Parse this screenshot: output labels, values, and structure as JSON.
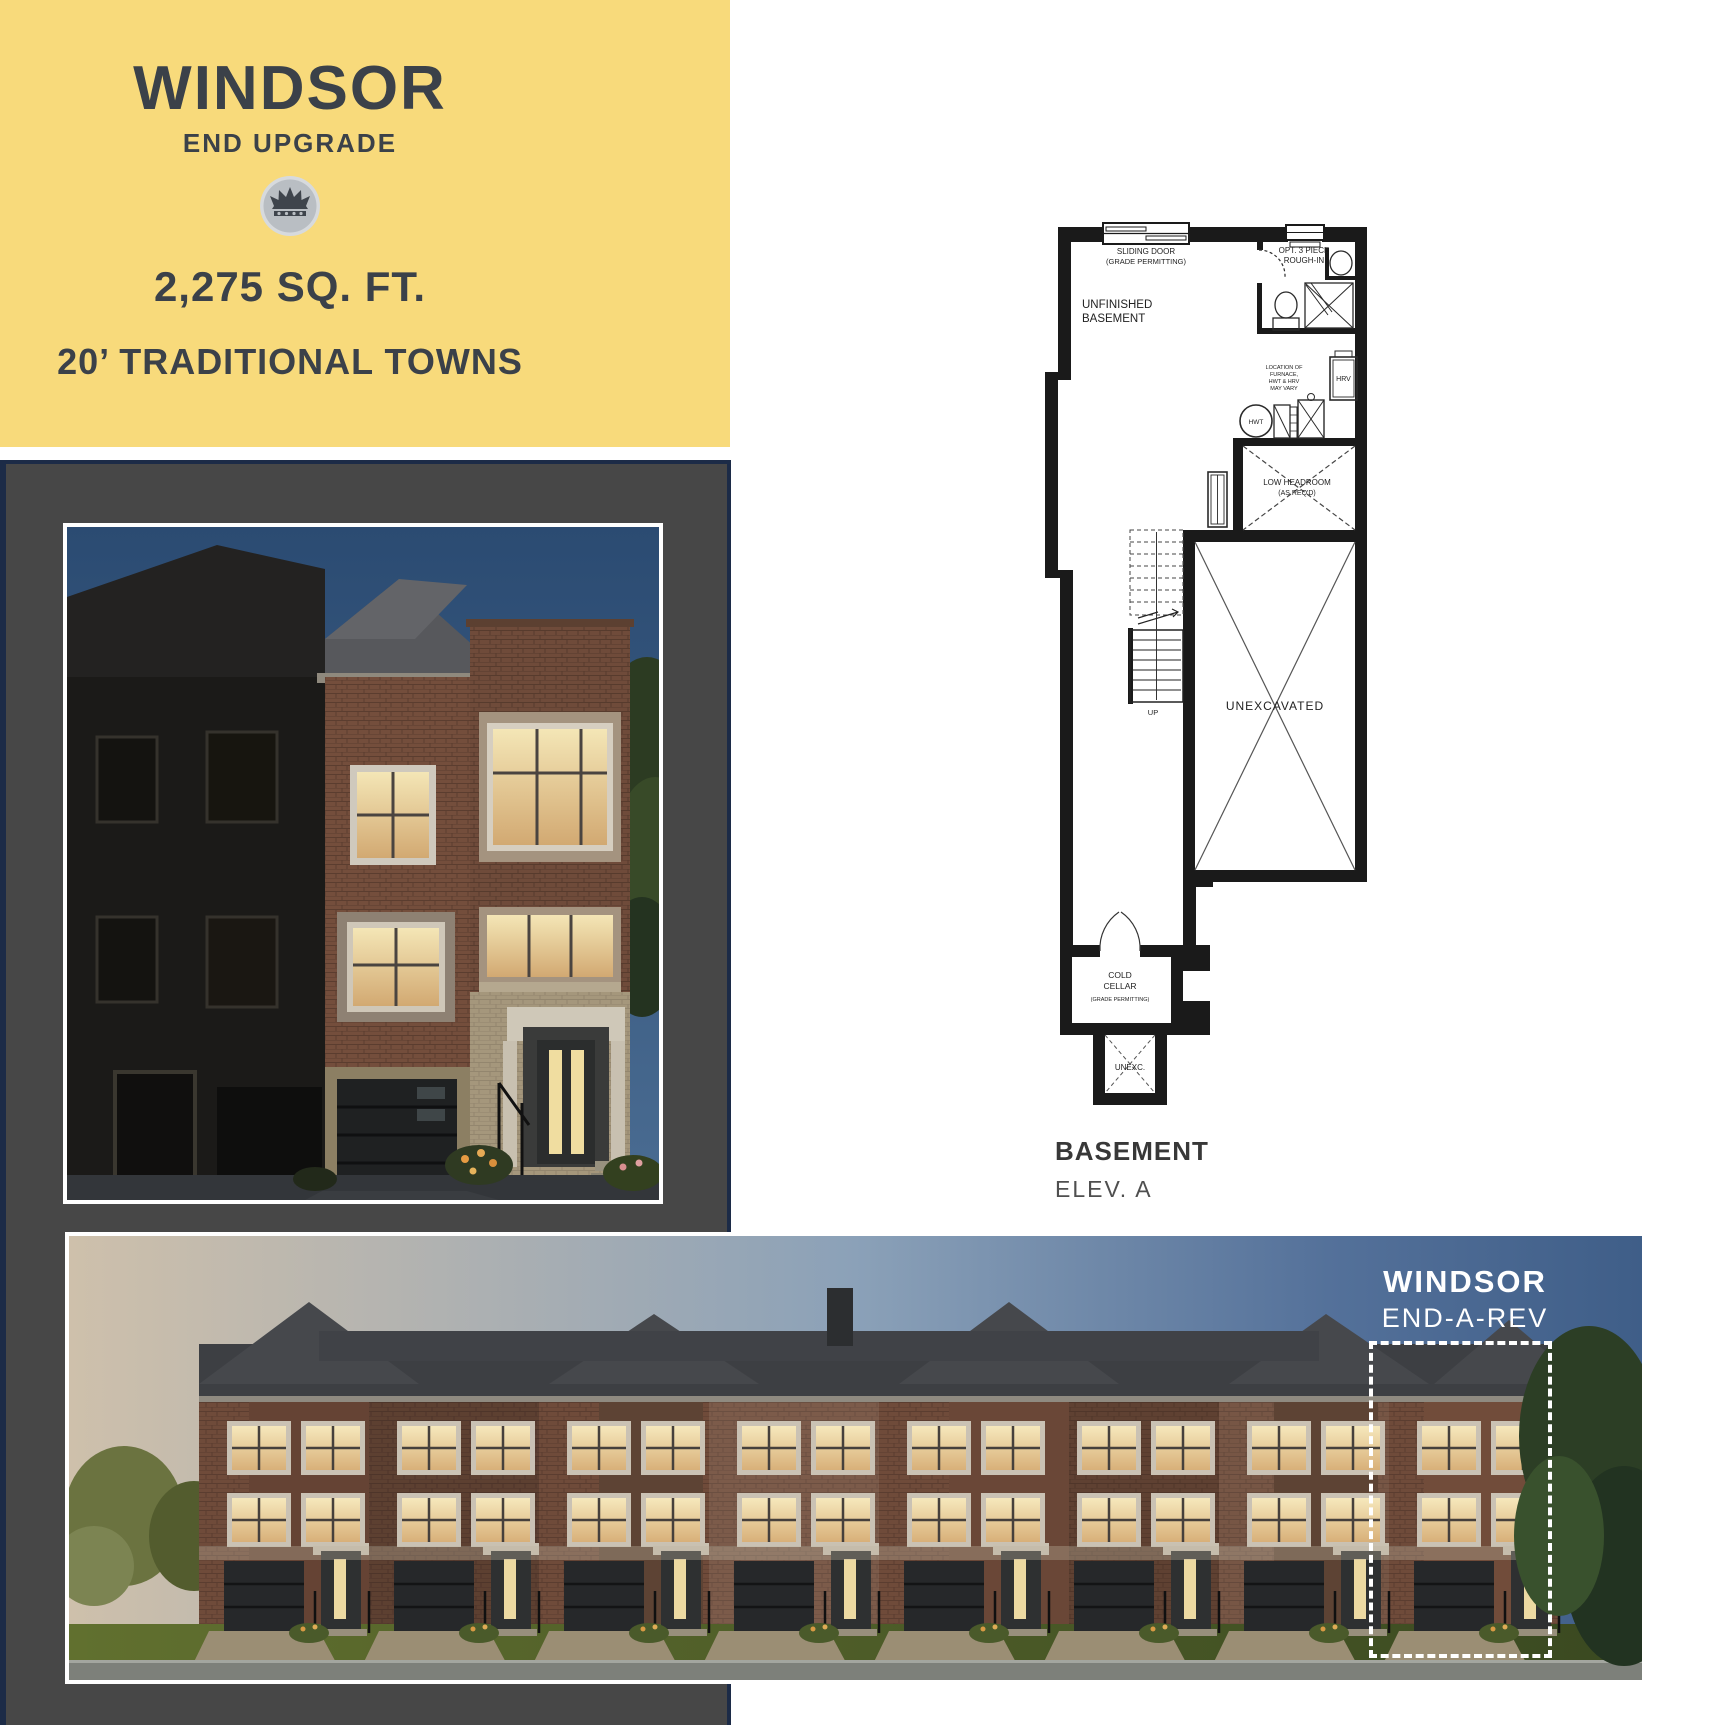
{
  "colors": {
    "banner_bg": "#F8DA7B",
    "banner_text": "#3B4149",
    "frame_navy": "#1C2B47",
    "panel_gray": "#474747",
    "highlight_white": "#FFFFFF",
    "plan_line": "#1A1A1A"
  },
  "banner": {
    "title": "WINDSOR",
    "subtitle": "END UPGRADE",
    "area": "2,275 SQ. FT.",
    "series": "20’ TRADITIONAL TOWNS",
    "badge_icon": "crown-icon"
  },
  "floorplan": {
    "sliding_door_1": "SLIDING DOOR",
    "sliding_door_2": "(GRADE PERMITTING)",
    "opt_roughin_1": "OPT. 3 PIECE",
    "opt_roughin_2": "ROUGH-IN",
    "unfinished_1": "UNFINISHED",
    "unfinished_2": "BASEMENT",
    "furnace_note_1": "LOCATION OF",
    "furnace_note_2": "FURNACE,",
    "furnace_note_3": "HWT & HRV",
    "furnace_note_4": "MAY VARY",
    "hrv": "HRV",
    "hwt": "HWT",
    "low_headroom_1": "LOW HEADROOM",
    "low_headroom_2": "(AS REQ'D)",
    "unexcavated": "UNEXCAVATED",
    "up": "UP",
    "cold_cellar_1": "COLD",
    "cold_cellar_2": "CELLAR",
    "cold_cellar_3": "(GRADE PERMITTING)",
    "unexc": "UNEXC."
  },
  "plan_caption": {
    "title": "BASEMENT",
    "elevation": "ELEV. A"
  },
  "streetscape": {
    "label_title": "WINDSOR",
    "label_sub": "END-A-REV"
  }
}
